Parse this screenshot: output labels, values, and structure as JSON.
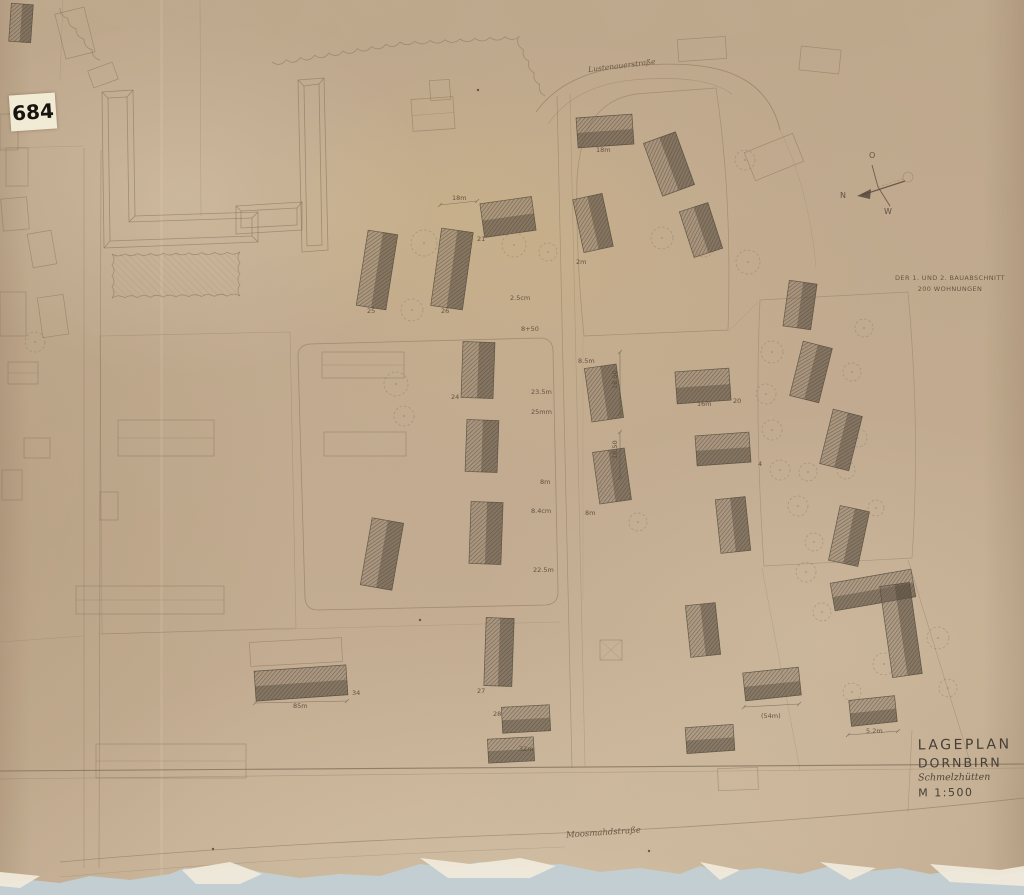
{
  "sticker": {
    "number": "684"
  },
  "annotation": {
    "line1": "DER 1. UND 2. BAUABSCHNITT",
    "line2": "200 WOHNUNGEN"
  },
  "title_block": {
    "title": "LAGEPLAN",
    "city": "DORNBIRN",
    "district": "Schmelzhütten",
    "scale": "M 1:500"
  },
  "streets": [
    {
      "name": "Lustenauerstraße"
    },
    {
      "name": "Moosmahdstraße"
    }
  ],
  "compass": {
    "labels": [
      {
        "t": "O",
        "x": 869,
        "y": 158
      },
      {
        "t": "N",
        "x": 840,
        "y": 198
      },
      {
        "t": "W",
        "x": 884,
        "y": 214
      }
    ],
    "spine": "M872,165 L878,187 L890,206",
    "dashline": "M878,187 L903,179",
    "arrowline": "M905,181 L862,195",
    "arrowhead": "857,196 871,189 870,199",
    "circle": {
      "cx": 908,
      "cy": 177,
      "r": 5
    }
  },
  "colors": {
    "paper": "#c9b296",
    "pencil": "#7d6c58",
    "pencil_dark": "#57493b",
    "building_stroke": "#4f463a",
    "hatch_base": "rgba(128,114,96,0.40)",
    "hatch_dark": "rgba(78,68,55,0.40)",
    "title": "#443f37",
    "backing": "#c3ced2",
    "shard": "#efe9da",
    "tree": "#8a7a65"
  },
  "map": {
    "paths": [
      {
        "d": "M0,771 L1024,764",
        "w": 1.1,
        "o": 0.75
      },
      {
        "d": "M0,779 L430,774",
        "w": 0.6,
        "o": 0.4
      },
      {
        "d": "M430,774 L1024,768",
        "w": 0.6,
        "o": 0.35
      },
      {
        "d": "M84,148 L84,868",
        "w": 0.7,
        "o": 0.38
      },
      {
        "d": "M101,150 L99,868",
        "w": 0.7,
        "o": 0.45
      },
      {
        "d": "M60,862 C250,845 420,838 560,833 C720,827 900,812 1024,798",
        "w": 0.8,
        "o": 0.5
      },
      {
        "d": "M60,877 C250,860 430,852 565,847",
        "w": 0.6,
        "o": 0.3
      },
      {
        "d": "M536,112 C556,84 588,70 630,66 C688,61 724,66 748,82 C766,94 776,112 780,130",
        "w": 0.8,
        "o": 0.55
      },
      {
        "d": "M548,124 C566,98 594,84 632,80 C682,76 712,80 732,94",
        "w": 0.6,
        "o": 0.4
      },
      {
        "d": "M557,96 L572,768",
        "w": 0.7,
        "o": 0.45
      },
      {
        "d": "M570,94 L585,766",
        "w": 0.6,
        "o": 0.32
      },
      {
        "d": "M310,344 L540,338 Q552,338 553,350 L558,592 Q558,604 546,605 L318,610 Q306,610 305,598 L298,356 Q298,345 310,344 Z",
        "w": 0.8,
        "o": 0.5
      },
      {
        "d": "M100,336 L290,332 L296,628 L102,634 Z",
        "w": 0.6,
        "o": 0.35
      },
      {
        "d": "M577,180 C580,130 596,100 636,94 L716,88 C727,160 731,240 728,330 L584,336 C579,286 576,232 577,180 Z",
        "w": 0.7,
        "o": 0.45
      },
      {
        "d": "M760,300 L908,292 C916,380 918,470 912,558 L764,566 C758,478 756,388 760,300 Z",
        "w": 0.7,
        "o": 0.4
      },
      {
        "d": "M908,560 L972,768",
        "w": 0.6,
        "o": 0.4
      },
      {
        "d": "M728,332 L758,302",
        "w": 0.5,
        "o": 0.3
      },
      {
        "d": "M98,634 L560,622",
        "w": 0.5,
        "o": 0.3
      },
      {
        "d": "M0,642 L84,636",
        "w": 0.5,
        "o": 0.3
      },
      {
        "d": "M200,0 L201,216",
        "w": 0.5,
        "o": 0.35
      },
      {
        "d": "M912,730 L908,812",
        "w": 0.6,
        "o": 0.4
      },
      {
        "d": "M762,568 L800,770",
        "w": 0.5,
        "o": 0.32
      },
      {
        "d": "M780,130 C800,170 812,220 816,268",
        "w": 0.5,
        "o": 0.28
      },
      {
        "d": "M63,0 L60,80",
        "w": 0.5,
        "o": 0.3
      },
      {
        "d": "M0,148 L84,146",
        "w": 0.5,
        "o": 0.3
      },
      {
        "d": "M583,338 L583,600",
        "w": 0.4,
        "o": 0.2
      }
    ],
    "scallops": [
      {
        "x1": 272,
        "y1": 62,
        "x2": 400,
        "y2": 42,
        "n": 9,
        "amp": 7
      },
      {
        "x1": 400,
        "y1": 42,
        "x2": 520,
        "y2": 36,
        "n": 8,
        "amp": 6
      },
      {
        "x1": 518,
        "y1": 38,
        "x2": 545,
        "y2": 96,
        "n": 5,
        "amp": 5
      },
      {
        "x1": 112,
        "y1": 254,
        "x2": 240,
        "y2": 252,
        "n": 10,
        "amp": 4
      },
      {
        "x1": 240,
        "y1": 252,
        "x2": 240,
        "y2": 296,
        "n": 4,
        "amp": 4
      },
      {
        "x1": 240,
        "y1": 296,
        "x2": 112,
        "y2": 298,
        "n": 10,
        "amp": 4
      },
      {
        "x1": 112,
        "y1": 298,
        "x2": 112,
        "y2": 254,
        "n": 4,
        "amp": 4
      },
      {
        "x1": 60,
        "y1": 8,
        "x2": 100,
        "y2": 60,
        "n": 5,
        "amp": 5
      }
    ],
    "garden": {
      "x": 114,
      "y": 254,
      "w": 124,
      "h": 42
    },
    "complex_paths": [
      "M102,92 L133,90 L135,216 L258,212 L258,242 L104,248 Z",
      "M108,98 L127,97 L129,222 L252,218 L252,236 L110,241 Z",
      "M102,92 L108,98 M133,90 L127,97 M258,212 L252,218 M258,242 L252,236 M104,248 L110,241 M135,216 L129,222",
      "M298,80 L324,78 L328,250 L302,252 Z",
      "M304,86 L319,84 L322,245 L307,246 Z",
      "M298,80 L304,86 M324,78 L319,84",
      "M236,206 L302,202 L302,230 L236,234 Z",
      "M241,211 L297,208 L297,225 L241,228 Z",
      "M236,206 L241,211 M302,202 L297,208"
    ],
    "outlines": [
      {
        "x": 6,
        "y": 148,
        "w": 22,
        "h": 38,
        "r": 0
      },
      {
        "x": 2,
        "y": 198,
        "w": 26,
        "h": 32,
        "r": -5
      },
      {
        "x": 30,
        "y": 232,
        "w": 24,
        "h": 34,
        "r": -10
      },
      {
        "x": 0,
        "y": 292,
        "w": 26,
        "h": 44,
        "r": 0
      },
      {
        "x": 40,
        "y": 296,
        "w": 26,
        "h": 40,
        "r": -8
      },
      {
        "x": 8,
        "y": 362,
        "w": 30,
        "h": 22,
        "r": 0,
        "ridge": true
      },
      {
        "x": 24,
        "y": 438,
        "w": 26,
        "h": 20,
        "r": 0
      },
      {
        "x": 2,
        "y": 470,
        "w": 20,
        "h": 30,
        "r": 0
      },
      {
        "x": 118,
        "y": 420,
        "w": 96,
        "h": 36,
        "r": 0,
        "ridge": true
      },
      {
        "x": 100,
        "y": 492,
        "w": 18,
        "h": 28,
        "r": 0
      },
      {
        "x": 76,
        "y": 586,
        "w": 148,
        "h": 28,
        "r": 0,
        "ridge": true
      },
      {
        "x": 96,
        "y": 744,
        "w": 150,
        "h": 34,
        "r": 0,
        "ridge": true
      },
      {
        "x": 60,
        "y": 10,
        "w": 30,
        "h": 46,
        "r": -14
      },
      {
        "x": 90,
        "y": 66,
        "w": 26,
        "h": 18,
        "r": -20
      },
      {
        "x": 412,
        "y": 98,
        "w": 42,
        "h": 32,
        "r": -4,
        "ridge": true
      },
      {
        "x": 430,
        "y": 80,
        "w": 20,
        "h": 20,
        "r": -4
      },
      {
        "x": 678,
        "y": 38,
        "w": 48,
        "h": 22,
        "r": -4
      },
      {
        "x": 800,
        "y": 48,
        "w": 40,
        "h": 24,
        "r": 6
      },
      {
        "x": 748,
        "y": 142,
        "w": 52,
        "h": 30,
        "r": -22
      },
      {
        "x": 600,
        "y": 640,
        "w": 22,
        "h": 20,
        "r": 0,
        "cross": true
      },
      {
        "x": 718,
        "y": 768,
        "w": 40,
        "h": 22,
        "r": -2
      },
      {
        "x": 322,
        "y": 352,
        "w": 82,
        "h": 26,
        "r": 0,
        "ridge": true
      },
      {
        "x": 324,
        "y": 432,
        "w": 82,
        "h": 24,
        "r": 0
      },
      {
        "x": 250,
        "y": 640,
        "w": 92,
        "h": 24,
        "r": -3
      },
      {
        "x": 0,
        "y": 114,
        "w": 18,
        "h": 36,
        "r": 0
      }
    ],
    "buildings": [
      {
        "x": 577,
        "y": 116,
        "w": 56,
        "h": 30,
        "r": -4
      },
      {
        "x": 652,
        "y": 136,
        "w": 34,
        "h": 56,
        "r": -20
      },
      {
        "x": 578,
        "y": 196,
        "w": 30,
        "h": 54,
        "r": -12
      },
      {
        "x": 686,
        "y": 206,
        "w": 30,
        "h": 48,
        "r": -18
      },
      {
        "x": 362,
        "y": 232,
        "w": 30,
        "h": 76,
        "r": 9
      },
      {
        "x": 436,
        "y": 230,
        "w": 32,
        "h": 78,
        "r": 8
      },
      {
        "x": 482,
        "y": 200,
        "w": 52,
        "h": 34,
        "r": -8
      },
      {
        "x": 462,
        "y": 342,
        "w": 32,
        "h": 56,
        "r": 2
      },
      {
        "x": 466,
        "y": 420,
        "w": 32,
        "h": 52,
        "r": 2
      },
      {
        "x": 470,
        "y": 502,
        "w": 32,
        "h": 62,
        "r": 2
      },
      {
        "x": 485,
        "y": 618,
        "w": 28,
        "h": 68,
        "r": 2
      },
      {
        "x": 502,
        "y": 706,
        "w": 48,
        "h": 26,
        "r": -3
      },
      {
        "x": 488,
        "y": 738,
        "w": 46,
        "h": 24,
        "r": -3
      },
      {
        "x": 366,
        "y": 520,
        "w": 32,
        "h": 68,
        "r": 10
      },
      {
        "x": 255,
        "y": 668,
        "w": 92,
        "h": 30,
        "r": -4
      },
      {
        "x": 588,
        "y": 366,
        "w": 32,
        "h": 54,
        "r": -8
      },
      {
        "x": 676,
        "y": 370,
        "w": 54,
        "h": 32,
        "r": -4
      },
      {
        "x": 696,
        "y": 434,
        "w": 54,
        "h": 30,
        "r": -4
      },
      {
        "x": 596,
        "y": 450,
        "w": 32,
        "h": 52,
        "r": -8
      },
      {
        "x": 718,
        "y": 498,
        "w": 30,
        "h": 54,
        "r": -6
      },
      {
        "x": 688,
        "y": 604,
        "w": 30,
        "h": 52,
        "r": -6
      },
      {
        "x": 786,
        "y": 282,
        "w": 28,
        "h": 46,
        "r": 8
      },
      {
        "x": 796,
        "y": 344,
        "w": 30,
        "h": 56,
        "r": 14
      },
      {
        "x": 826,
        "y": 412,
        "w": 30,
        "h": 56,
        "r": 14
      },
      {
        "x": 834,
        "y": 508,
        "w": 30,
        "h": 56,
        "r": 12
      },
      {
        "x": 832,
        "y": 576,
        "w": 82,
        "h": 28,
        "r": -10
      },
      {
        "x": 886,
        "y": 584,
        "w": 30,
        "h": 92,
        "r": -8
      },
      {
        "x": 744,
        "y": 670,
        "w": 56,
        "h": 28,
        "r": -6
      },
      {
        "x": 850,
        "y": 698,
        "w": 46,
        "h": 26,
        "r": -6
      },
      {
        "x": 686,
        "y": 726,
        "w": 48,
        "h": 26,
        "r": -4
      },
      {
        "x": 10,
        "y": 4,
        "w": 22,
        "h": 38,
        "r": 4
      }
    ],
    "trees": [
      [
        424,
        243,
        13
      ],
      [
        514,
        245,
        12
      ],
      [
        412,
        310,
        11
      ],
      [
        396,
        384,
        12
      ],
      [
        404,
        416,
        10
      ],
      [
        548,
        252,
        9
      ],
      [
        662,
        238,
        11
      ],
      [
        704,
        246,
        11
      ],
      [
        748,
        262,
        12
      ],
      [
        745,
        160,
        10
      ],
      [
        772,
        352,
        11
      ],
      [
        766,
        394,
        10
      ],
      [
        772,
        430,
        10
      ],
      [
        780,
        470,
        10
      ],
      [
        808,
        472,
        9
      ],
      [
        798,
        506,
        10
      ],
      [
        814,
        542,
        9
      ],
      [
        846,
        470,
        9
      ],
      [
        858,
        438,
        9
      ],
      [
        852,
        372,
        9
      ],
      [
        864,
        328,
        9
      ],
      [
        876,
        508,
        8
      ],
      [
        806,
        572,
        10
      ],
      [
        884,
        664,
        11
      ],
      [
        938,
        638,
        11
      ],
      [
        852,
        692,
        9
      ],
      [
        822,
        612,
        9
      ],
      [
        948,
        688,
        9
      ],
      [
        610,
        486,
        10
      ],
      [
        638,
        522,
        9
      ],
      [
        35,
        342,
        10
      ]
    ],
    "dims": [
      [
        255,
        703,
        347,
        701
      ],
      [
        744,
        707,
        799,
        704
      ],
      [
        848,
        735,
        898,
        731
      ],
      [
        440,
        205,
        477,
        201
      ],
      [
        620,
        352,
        620,
        414
      ],
      [
        620,
        432,
        620,
        478
      ]
    ],
    "labels": [
      {
        "t": "18m",
        "x": 596,
        "y": 152
      },
      {
        "t": "2m",
        "x": 576,
        "y": 264
      },
      {
        "t": "21",
        "x": 477,
        "y": 241
      },
      {
        "t": "18m",
        "x": 452,
        "y": 200
      },
      {
        "t": "25",
        "x": 367,
        "y": 313
      },
      {
        "t": "26",
        "x": 441,
        "y": 313
      },
      {
        "t": "2.5cm",
        "x": 510,
        "y": 300
      },
      {
        "t": "8+50",
        "x": 521,
        "y": 331
      },
      {
        "t": "23.5m",
        "x": 531,
        "y": 394
      },
      {
        "t": "25mm",
        "x": 531,
        "y": 414
      },
      {
        "t": "24",
        "x": 451,
        "y": 399
      },
      {
        "t": "8m",
        "x": 540,
        "y": 484
      },
      {
        "t": "8.4cm",
        "x": 531,
        "y": 513
      },
      {
        "t": "22.5m",
        "x": 533,
        "y": 572
      },
      {
        "t": "8.5m",
        "x": 578,
        "y": 363
      },
      {
        "t": "18.50",
        "x": 617,
        "y": 389,
        "r": -90
      },
      {
        "t": "18.50",
        "x": 617,
        "y": 459,
        "r": -90
      },
      {
        "t": "8m",
        "x": 585,
        "y": 515
      },
      {
        "t": "20",
        "x": 733,
        "y": 403
      },
      {
        "t": "16m",
        "x": 697,
        "y": 406
      },
      {
        "t": "4",
        "x": 758,
        "y": 466
      },
      {
        "t": "34",
        "x": 352,
        "y": 695
      },
      {
        "t": "85m",
        "x": 293,
        "y": 708
      },
      {
        "t": "27",
        "x": 477,
        "y": 693
      },
      {
        "t": "28",
        "x": 493,
        "y": 716
      },
      {
        "t": "32m",
        "x": 519,
        "y": 751
      },
      {
        "t": "(54m)",
        "x": 761,
        "y": 718
      },
      {
        "t": "5.2m",
        "x": 866,
        "y": 733
      }
    ],
    "specks": [
      [
        213,
        849
      ],
      [
        649,
        851
      ],
      [
        478,
        90
      ],
      [
        420,
        620
      ]
    ],
    "torn_edge": "0,884 30,880 60,883 90,876 130,880 170,874 185,868 210,872 235,866 260,872 300,878 340,874 380,876 420,864 450,868 480,862 520,866 560,864 600,872 640,868 680,874 700,866 720,872 760,868 800,874 830,866 860,872 900,868 930,874 960,870 990,876 1024,872 1024,895 0,895",
    "shards": [
      "182,870 230,862 262,874 240,884 196,884",
      "420,858 470,864 520,858 556,866 530,878 448,878",
      "700,862 740,870 720,880",
      "820,862 876,868 850,880",
      "930,864 1000,870 1024,866 1024,886 950,882",
      "0,872 40,876 20,888 0,886"
    ]
  }
}
